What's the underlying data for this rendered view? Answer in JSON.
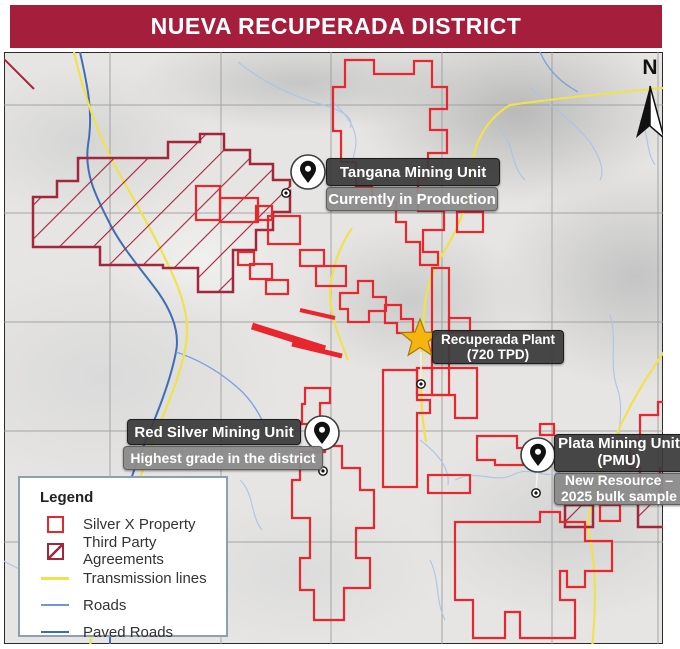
{
  "header": {
    "title": "NUEVA RECUPERADA DISTRICT"
  },
  "north_indicator": {
    "label": "N"
  },
  "callouts": {
    "tangana": {
      "title": "Tangana Mining Unit",
      "subtitle": "Currently in Production"
    },
    "recuperada": {
      "title": "Recuperada Plant",
      "subtitle": "(720 TPD)"
    },
    "red_silver": {
      "title": "Red Silver Mining Unit",
      "subtitle": "Highest grade in the district"
    },
    "plata": {
      "title": "Plata Mining Unit (PMU)",
      "subtitle": "New Resource – 2025 bulk sample"
    }
  },
  "legend": {
    "title": "Legend",
    "items": [
      {
        "label": "Silver X Property",
        "swatch": "red-outline-square"
      },
      {
        "label": "Third Party Agreements",
        "swatch": "maroon-hatched-square"
      },
      {
        "label": "Transmission lines",
        "swatch": "yellow-line"
      },
      {
        "label": "Roads",
        "swatch": "light-blue-line"
      },
      {
        "label": "Paved Roads",
        "swatch": "blue-line"
      }
    ]
  },
  "colors": {
    "banner": "#A51E3C",
    "silver_x_property": "#E8262E",
    "third_party_agreements": "#A3273A",
    "transmission_lines": "#EFE24C",
    "roads": "#7097CE",
    "paved_roads": "#3A6BB8",
    "plant_star": "#F6B40E",
    "callout_dark": "#3B3B3B",
    "callout_gray": "#8A8A8A"
  }
}
